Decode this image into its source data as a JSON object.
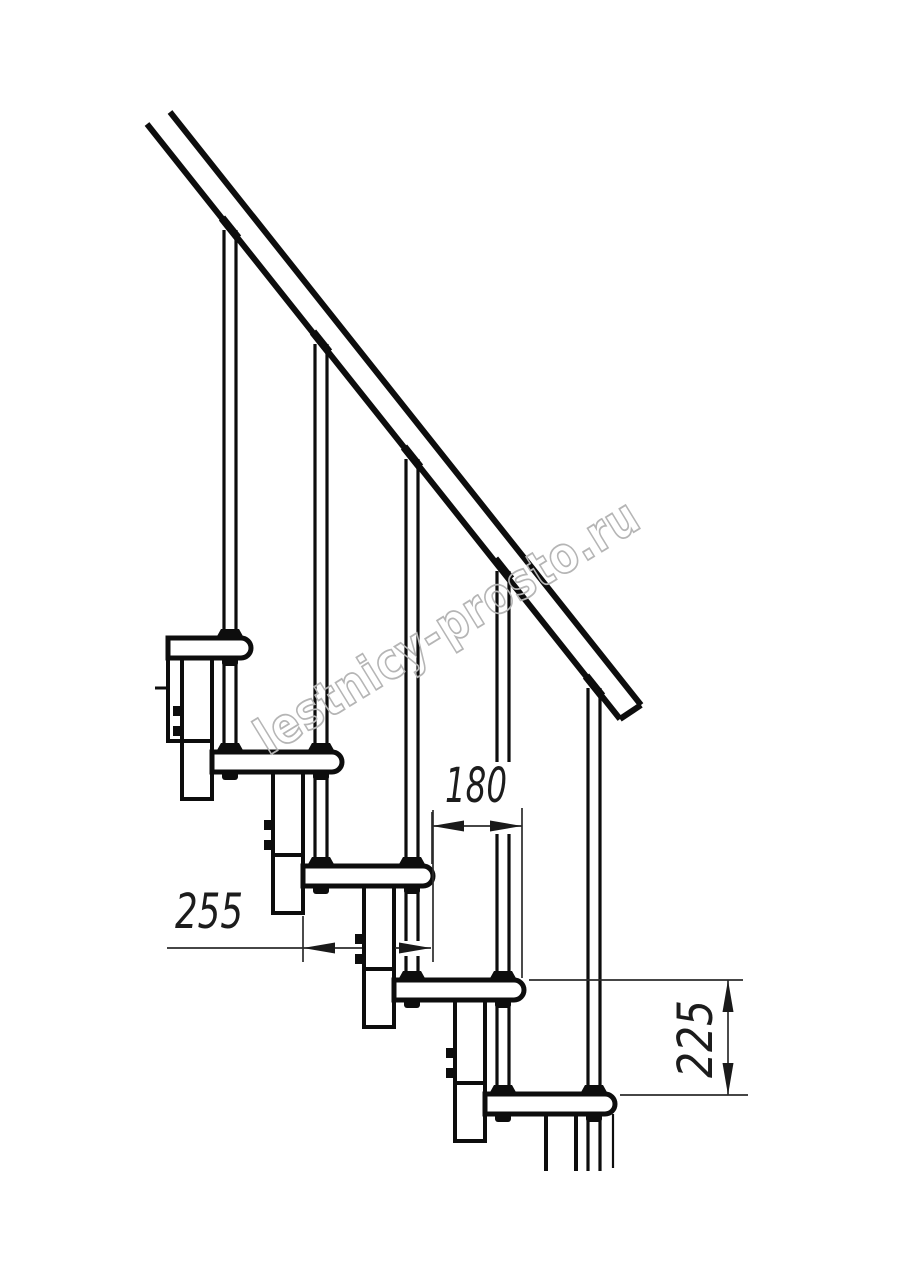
{
  "drawing": {
    "type": "modular-staircase-side-elevation",
    "background": "#ffffff",
    "line_color": "#0d0d0d",
    "dim_line_color": "#2b2b2b",
    "dims": {
      "tread_offset": {
        "value": "180",
        "orientation": "horizontal"
      },
      "tread_length": {
        "value": "255",
        "orientation": "horizontal"
      },
      "riser_height": {
        "value": "225",
        "orientation": "vertical"
      }
    },
    "watermark": {
      "text": "lestnicy-prosto.ru",
      "color": "#b5b5b5"
    }
  }
}
